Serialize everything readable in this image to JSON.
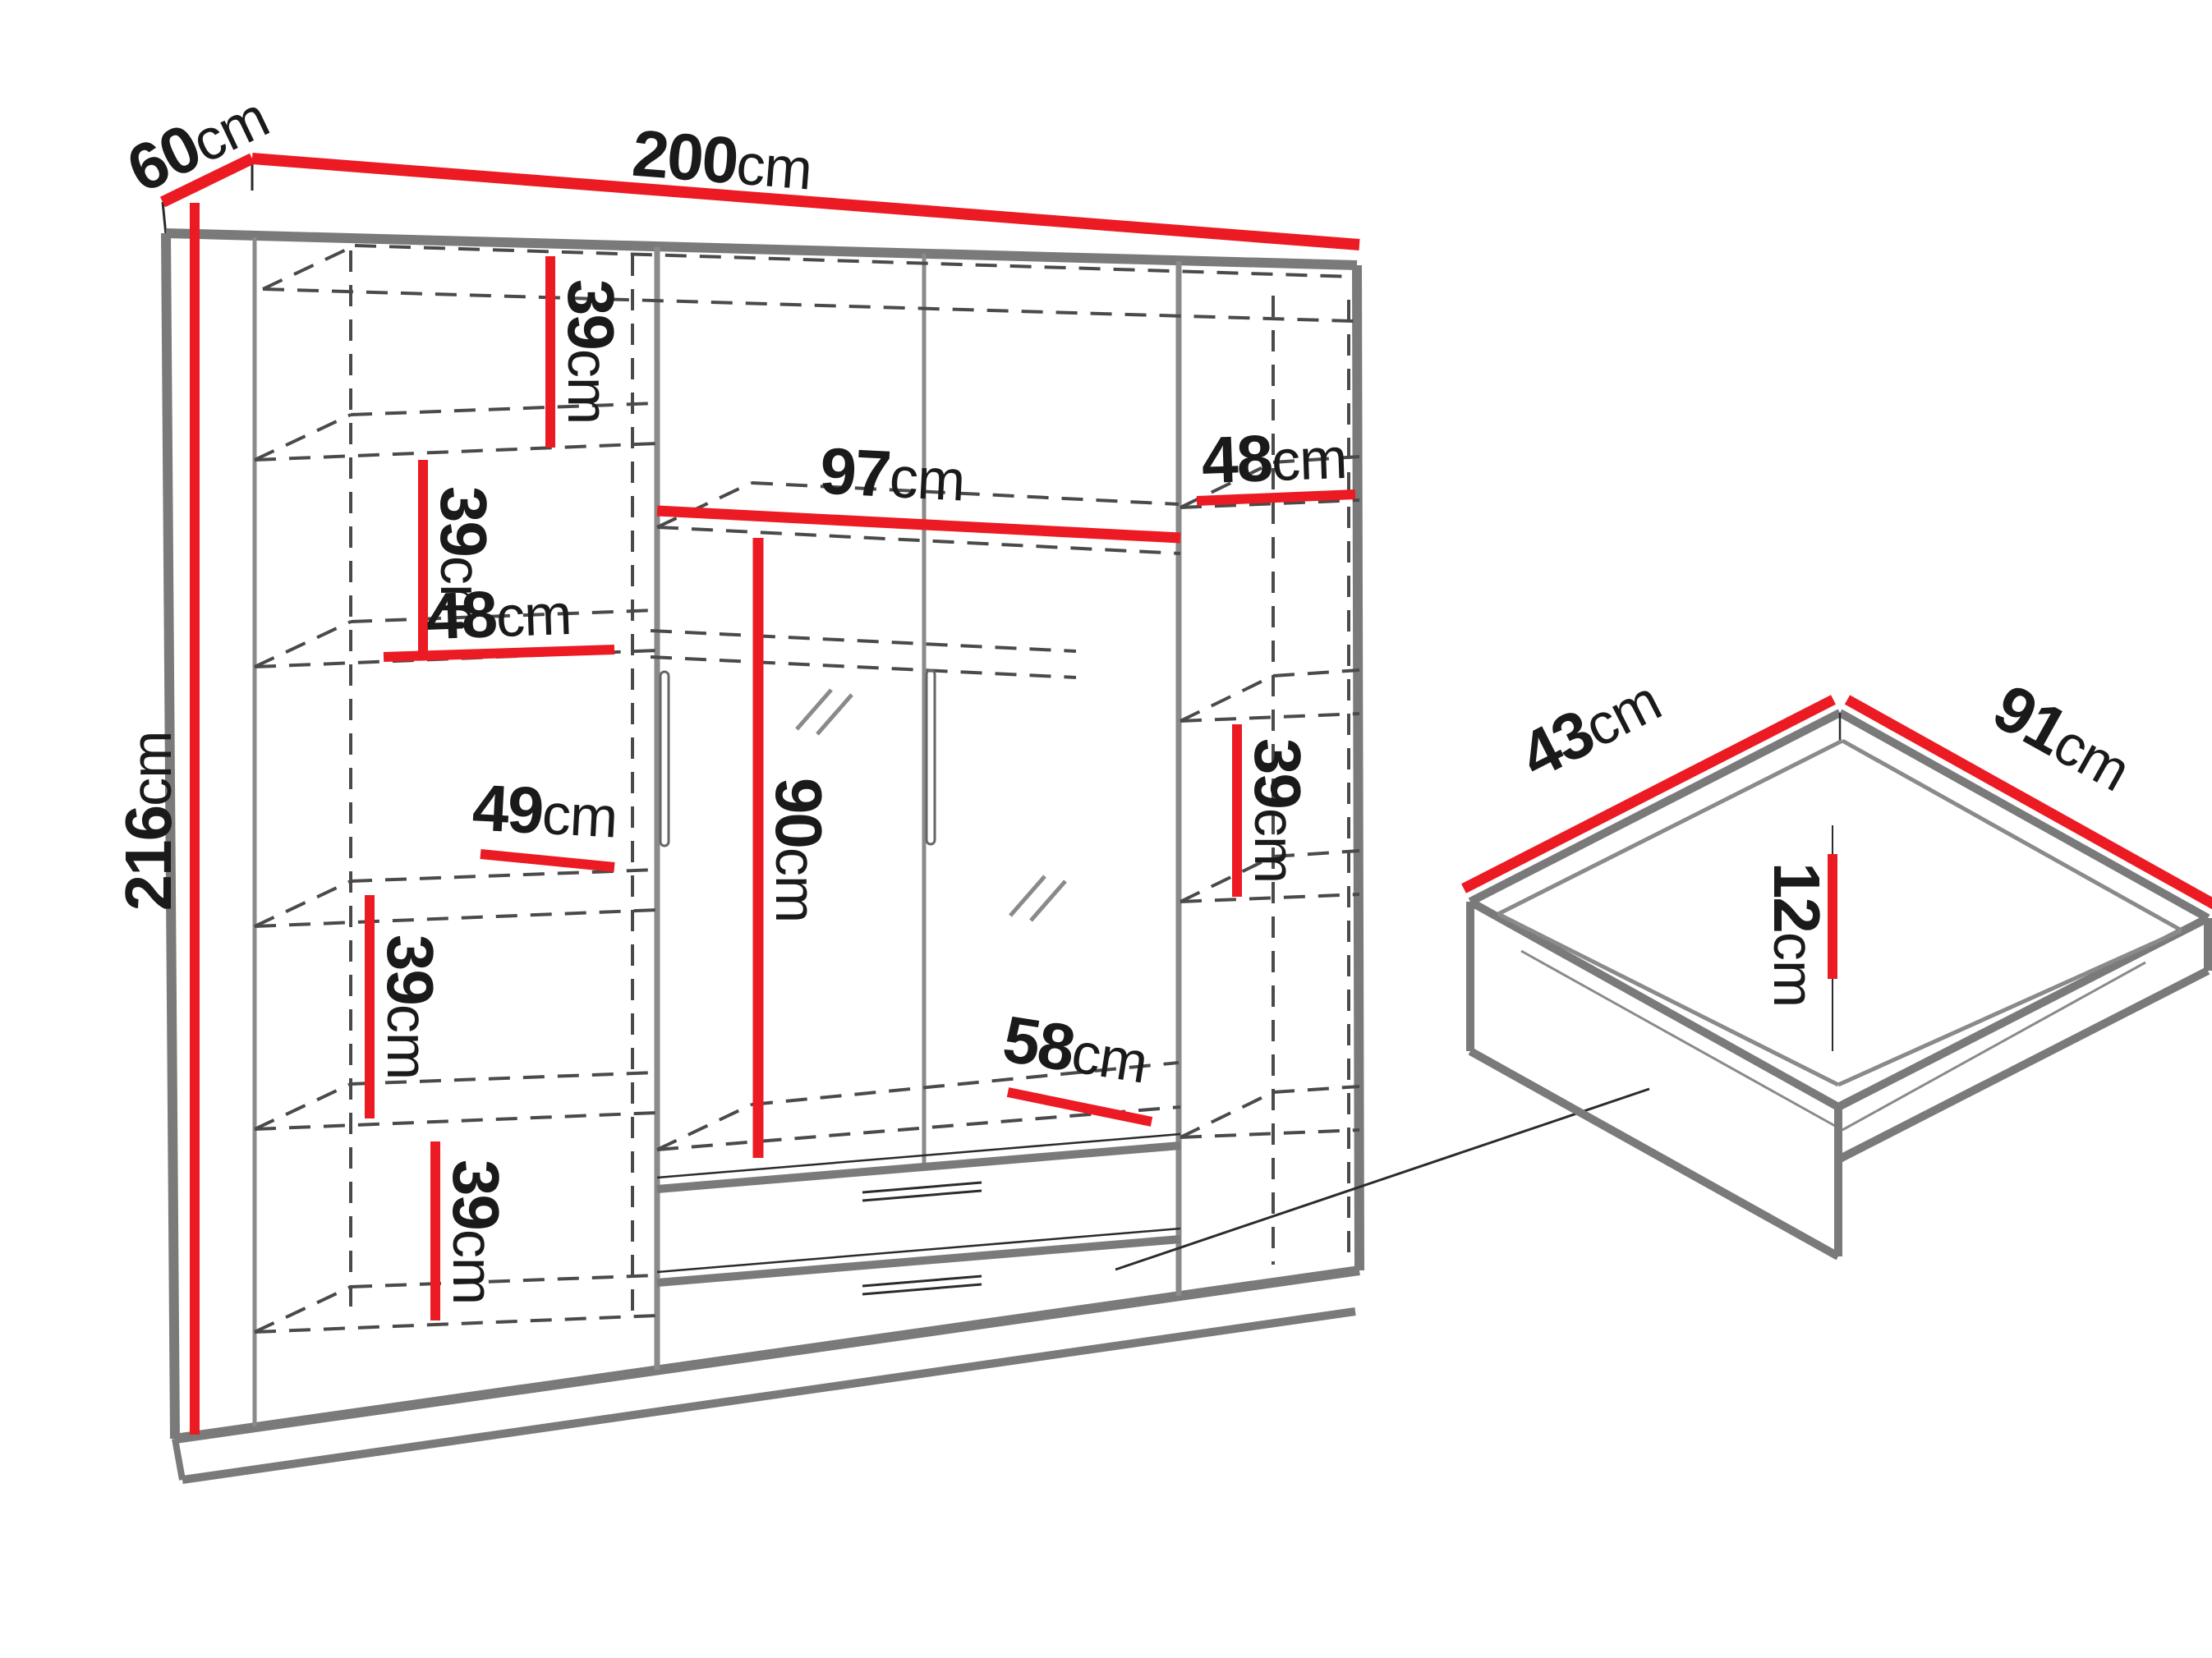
{
  "diagram_title": "wardrobe-dimension-diagram",
  "colors": {
    "dimension_red": "#ec1b23",
    "outline_gray": "#7a7a7a"
  },
  "dims": {
    "depth": {
      "value": "60",
      "unit": "cm"
    },
    "width": {
      "value": "200",
      "unit": "cm"
    },
    "height": {
      "value": "216",
      "unit": "cm"
    },
    "left_gap1": {
      "value": "39",
      "unit": "cm"
    },
    "left_gap2": {
      "value": "39",
      "unit": "cm"
    },
    "left_width": {
      "value": "48",
      "unit": "cm"
    },
    "left_gap3": {
      "value": "49",
      "unit": "cm"
    },
    "left_gap4": {
      "value": "39",
      "unit": "cm"
    },
    "left_gap5": {
      "value": "39",
      "unit": "cm"
    },
    "mid_width": {
      "value": "97",
      "unit": "cm"
    },
    "mid_hang": {
      "value": "90",
      "unit": "cm"
    },
    "mid_bottom": {
      "value": "58",
      "unit": "cm"
    },
    "right_width": {
      "value": "48",
      "unit": "cm"
    },
    "right_gap": {
      "value": "39",
      "unit": "cm"
    },
    "drawer_depth": {
      "value": "43",
      "unit": "cm"
    },
    "drawer_width": {
      "value": "91",
      "unit": "cm"
    },
    "drawer_height": {
      "value": "12",
      "unit": "cm"
    }
  }
}
